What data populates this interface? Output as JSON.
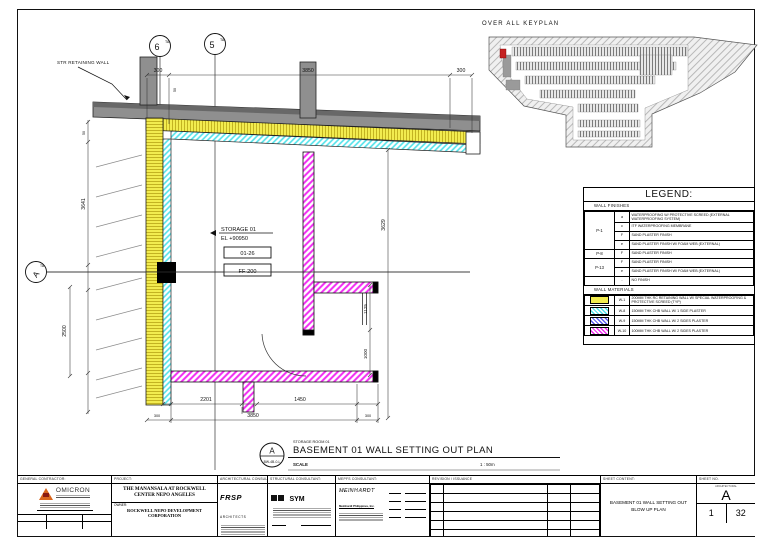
{
  "keyplan": {
    "title": "OVER ALL KEYPLAN",
    "highlight_color": "#c52222"
  },
  "plan": {
    "grid": {
      "col1": "6",
      "col1_sup": "TA",
      "col2": "5",
      "col2_sup": "TA",
      "row1": "A",
      "row1_sup": "TA"
    },
    "labels": {
      "retaining_wall": "STR RETAINING WALL",
      "room_name": "STORAGE 01",
      "room_elev": "EL +90950",
      "tag1": "01-26",
      "tag2": "FF-200"
    },
    "dims": {
      "top_left": "300",
      "top_mid": "3850",
      "top_right": "300",
      "top_small": "50",
      "left_upper": "3641",
      "left_small": "50",
      "left_lower": "2500",
      "right_outer": "3629",
      "right_upper": "1125",
      "right_lower": "1000",
      "bottom_1": "2201",
      "bottom_2": "1450",
      "bottom_total": "3850",
      "bottom_left_small": "300",
      "bottom_right_small": "300"
    },
    "title": {
      "bubble_letter": "A",
      "bubble_ref": "BW-4B-0-L",
      "overline": "STORAGE ROOM 01",
      "text": "BASEMENT 01 WALL SETTING OUT PLAN",
      "scale_label": "SCALE",
      "scale_value": "1 : 50m"
    }
  },
  "legend": {
    "title": "LEGEND:",
    "finishes_header": "WALL FINISHES",
    "materials_header": "WALL MATERIALS",
    "groups": [
      "P-1",
      "P-8",
      "P-13",
      ""
    ],
    "finishes": [
      {
        "code": "a",
        "desc": "WATERPROOFING W/ PROTECTIVE SCREED (EXTERNAL WATERPROOFING SYSTEM)"
      },
      {
        "code": "c",
        "desc": "ITF WATERPROOFING MEMBRANE"
      },
      {
        "code": "F",
        "desc": "SAND PLASTER FINISH"
      },
      {
        "code": "e",
        "desc": "SAND PLASTER FINISH W/ FOAM WEB (EXTERNAL)"
      },
      {
        "code": "F",
        "desc": "SAND PLASTER FINISH"
      },
      {
        "code": "F",
        "desc": "SAND PLASTER FINISH"
      },
      {
        "code": "e",
        "desc": "SAND PLASTER FINISH W/ FOAM WEB (EXTERNAL)"
      },
      {
        "code": "-",
        "desc": "NO FINISH"
      }
    ],
    "materials": [
      {
        "code": "W-1",
        "desc": "200MM THK RC RETAINING WALL W/ SPECIAL WATERPROOFING & PROTECTIVE SCREED (TYP)",
        "swatch": "yellow"
      },
      {
        "code": "W-8",
        "desc": "150MM THK CHB WALL W/ 1 SIDE PLASTER",
        "swatch": "cyan"
      },
      {
        "code": "W-9",
        "desc": "150MM THK CHB WALL W/ 2 SIDES PLASTER",
        "swatch": "blue"
      },
      {
        "code": "W-10",
        "desc": "100MM THK CHB WALL W/ 2 SIDES PLASTER",
        "swatch": "magenta"
      }
    ],
    "colors": {
      "yellow": "#f2ec4f",
      "cyan": "#4fe2ea",
      "blue": "#5b5bf0",
      "magenta": "#f22af2"
    }
  },
  "titleblock": {
    "general_contractor": {
      "label": "GENERAL CONTRACTOR:",
      "name": "OMICRON"
    },
    "project": {
      "label": "PROJECT:",
      "name": "THE MANANSALA AT ROCKWELL CENTER NEPO ANGELES",
      "owner_label": "OWNER:",
      "owner": "ROCKWELL NEPO DEVELOPMENT CORPORATION"
    },
    "architectural": {
      "label": "ARCHITECTURAL CONSULTANT:",
      "logo": "FRSP",
      "logo_sub": "ARCHITECTS"
    },
    "structural": {
      "label": "STRUCTURAL CONSULTANT:",
      "logo": "SYM"
    },
    "mepfs": {
      "label": "MEPFS CONSULTANT:",
      "logo": "MEINHARDT",
      "logo_sub": "Meinhardt Philippines, Inc."
    },
    "revision": {
      "label": "REVISION / ISSUANCE"
    },
    "sheet_content": {
      "label": "SHEET CONTENT:",
      "line1": "BASEMENT 01 WALL SETTING OUT",
      "line2": "BLOW UP PLAN"
    },
    "sheet_no": {
      "label": "SHEET NO.",
      "discipline": "ARCHITECTURAL",
      "letter": "A",
      "num1": "1",
      "num2": "32"
    }
  }
}
